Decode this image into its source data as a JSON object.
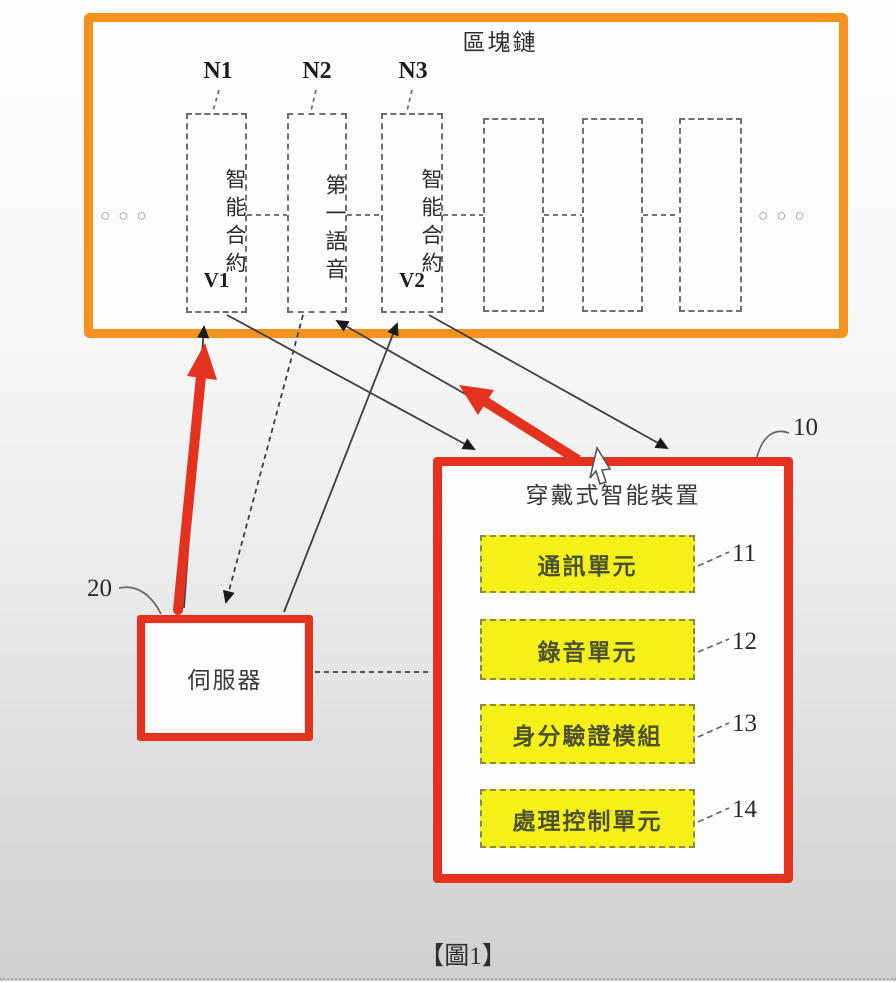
{
  "figure": {
    "caption": "【圖1】"
  },
  "blockchain": {
    "title": "區塊鏈",
    "nodes": [
      {
        "label": "N1",
        "block_text": "智能合約",
        "version": "V1"
      },
      {
        "label": "N2",
        "block_text": "第一語音",
        "version": ""
      },
      {
        "label": "N3",
        "block_text": "智能合約",
        "version": "V2"
      }
    ],
    "ellipsis_left": "○○○",
    "ellipsis_right": "○○○"
  },
  "device": {
    "ref": "10",
    "title": "穿戴式智能裝置",
    "units": [
      {
        "ref": "11",
        "label": "通訊單元"
      },
      {
        "ref": "12",
        "label": "錄音單元"
      },
      {
        "ref": "13",
        "label": "身分驗證模組"
      },
      {
        "ref": "14",
        "label": "處理控制單元"
      }
    ]
  },
  "server": {
    "ref": "20",
    "label": "伺服器"
  },
  "colors": {
    "blockchain_border": "#f5921e",
    "annotation_red": "#e4321f",
    "unit_fill": "#f6f019",
    "line_gray": "#444444"
  }
}
